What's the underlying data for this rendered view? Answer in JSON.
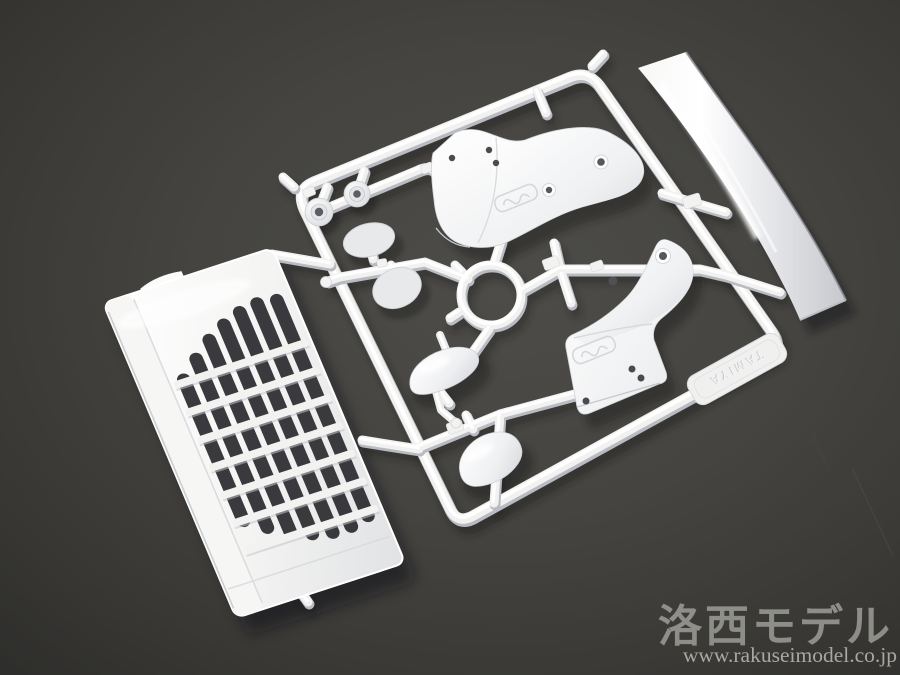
{
  "photo": {
    "description": "Injection-molded white plastic model sprue (parts tree) with truck body parts, photographed on a dark gray studio background",
    "colors": {
      "background_center": "#4d4c48",
      "background_edge": "#2b2b29",
      "plastic": "#f1f1f0",
      "plastic_shade": "#babdc3",
      "grille_slot_dark": "#2f2f33",
      "shadow": "#121216"
    },
    "sprue": {
      "embossed_text": "TAMIYA",
      "parts": [
        "runner-frame",
        "front-grille-panel",
        "side-visor-strip",
        "step-fender-left",
        "step-fender-right",
        "mirror-face-upper",
        "mirror-face-lower",
        "mirror-housing-upper",
        "mirror-housing-lower",
        "mirror-arm-upper",
        "mirror-arm-lower",
        "grommet-cap-left",
        "grommet-cap-right",
        "ring-collar",
        "molded-brand-tag"
      ]
    },
    "watermark": {
      "brand": "洛西モデル",
      "url": "www.rakuseimodel.co.jp",
      "text_color": "#aaaaa5"
    }
  }
}
